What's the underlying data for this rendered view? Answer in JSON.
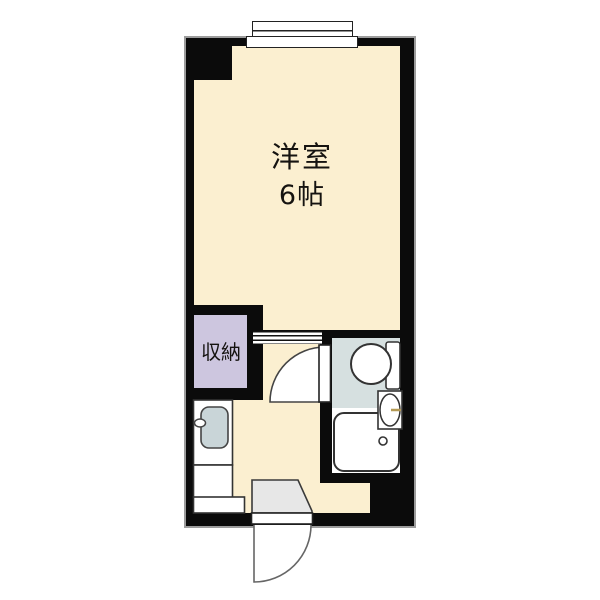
{
  "plan": {
    "main_room": {
      "name": "洋室",
      "size": "6帖"
    },
    "closet": {
      "name": "収納"
    },
    "colors": {
      "wall": "#0b0b0b",
      "wall_outline": "#9c9c9c",
      "room_floor": "#FBEFD0",
      "closet_floor": "#CDC6DF",
      "toilet_floor": "#D6E0E0",
      "bath_floor": "#FFFFFF",
      "kitchen_sink": "#C9D5D8",
      "entrance_step": "#E7E7E7",
      "faucet_accent": "#B49A55"
    },
    "fixtures": {
      "window": "sliding-window",
      "partition": "sliding-partition",
      "toilet": "toilet",
      "washbasin": "washbasin",
      "bathtub": "bathtub",
      "kitchen_sink": "kitchen-sink",
      "entrance_door": "hinged-door-outswing",
      "bathroom_door": "hinged-door-inswing"
    }
  }
}
